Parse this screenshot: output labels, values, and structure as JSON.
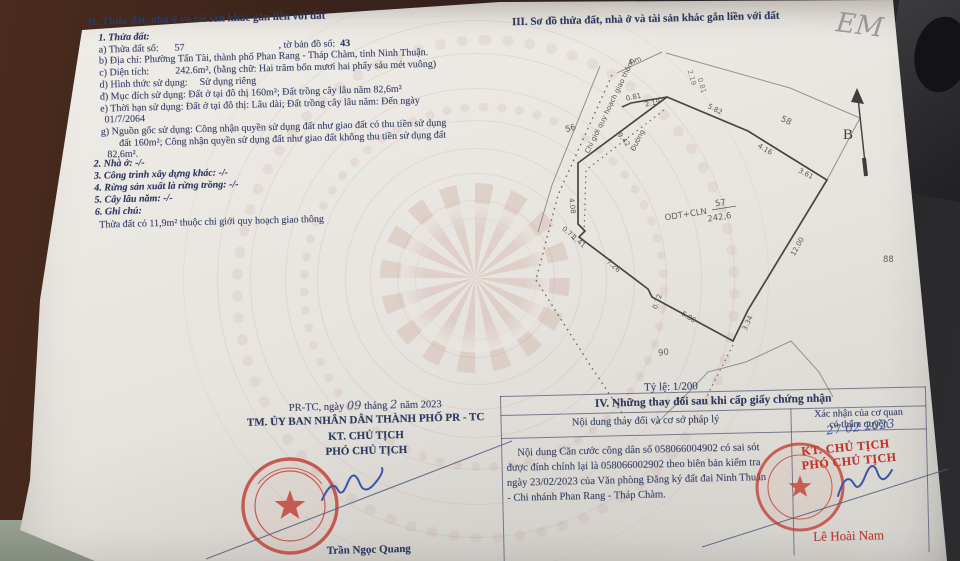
{
  "photo": {
    "pencil_mark": "EM"
  },
  "sec2": {
    "title": "II. Thửa đất, nhà ở và tài sản khác gắn liền với đất",
    "item1": "1. Thửa đất:",
    "a_label": "a) Thửa đất số:",
    "a_value": "57",
    "a_sep": ", tờ bản đồ số:",
    "a_map": "43",
    "b": "b) Địa chỉ: Phường Tấn Tài, thành phố Phan Rang - Tháp Chàm, tỉnh Ninh Thuận.",
    "c_label": "c) Diện tích:",
    "c_value": "242.6m²",
    "c_rest": ", (bằng chữ: Hai trăm bốn mươi hai phẩy sáu mét vuông)",
    "d_label": "d) Hình thức sử dụng:",
    "d_value": "Sử dụng riêng",
    "dd": "đ) Mục đích sử dụng: Đất ở tại đô thị 160m²; Đất trồng cây lâu năm 82,6m²",
    "e1": "e) Thời hạn sử dụng: Đất ở tại đô thị: Lâu dài; Đất trồng cây lâu năm: Đến ngày",
    "e2": "01/7/2064",
    "g1": "g) Nguồn gốc sử dụng: Công nhận quyền sử dụng đất như giao đất có thu tiền sử dụng",
    "g2": "đất 160m²; Công nhận quyền sử dụng đất như giao đất không thu tiền sử dụng đất",
    "g3": "82,6m².",
    "item2": "2. Nhà ở: -/-",
    "item3": "3. Công trình xây dựng khác: -/-",
    "item4": "4. Rừng sản xuất là rừng trồng: -/-",
    "item5": "5. Cây lâu năm: -/-",
    "item6": "6. Ghi chú:",
    "note": "Thửa đất có 11,9m² thuộc chỉ giới quy hoạch giao thông"
  },
  "sec3": {
    "title": "III. Sơ đồ thửa đất, nhà ở và tài sản khác gắn liền với đất",
    "scale": "Tỷ lệ: 1/200",
    "north": "B",
    "map": {
      "use_code": "ODT+CLN",
      "parcel_no": "57",
      "area": "242,6",
      "road": "Đường",
      "planning": "Chỉ giới quy hoạch giao thông",
      "road_w": "4 m",
      "n56": "56",
      "n58": "58",
      "n88": "88",
      "n90": "90",
      "d081": "0.81",
      "d219": "2.19",
      "d582": "5.82",
      "d416": "4.16",
      "d361": "3.61",
      "d1200": "12.00",
      "d334": "3.34",
      "d680": "6.80",
      "d072": "0.72",
      "d726": "7.26",
      "d141": "1.41",
      "d071": "0.71",
      "d408": "4.08",
      "d942": "9.42"
    }
  },
  "sec4": {
    "title": "IV. Những thay đổi sau khi cấp giấy chứng nhận",
    "col1": "Nội dung thay đổi và cơ sở pháp lý",
    "col2_l1": "Xác nhận của cơ quan",
    "col2_l2": "có thẩm quyền",
    "body1": "Nội dung Căn cước công dân số 058066004902 có sai sót",
    "body2": "được đính chính lại là 058066002902 theo biên bản kiểm tra",
    "body3": "ngày 23/02/2023 của Văn phòng Đăng ký đất đai Ninh Thuận",
    "body4": "- Chi nhánh Phan Rang - Tháp Chàm.",
    "hw_date": "27 02 2023",
    "stamp1": "KT. CHỦ TỊCH",
    "stamp2": "PHÓ CHỦ TỊCH",
    "signer": "Lê Hoài Nam"
  },
  "sign": {
    "d1": "PR-TC, ngày",
    "day": "09",
    "d2": "tháng",
    "month": "2",
    "d3": "năm 2023",
    "board": "TM. ỦY BAN NHÂN DÂN THÀNH PHỐ PR - TC",
    "t1": "KT. CHỦ TỊCH",
    "t2": "PHÓ CHỦ TỊCH",
    "signer": "Trần Ngọc Quang"
  }
}
